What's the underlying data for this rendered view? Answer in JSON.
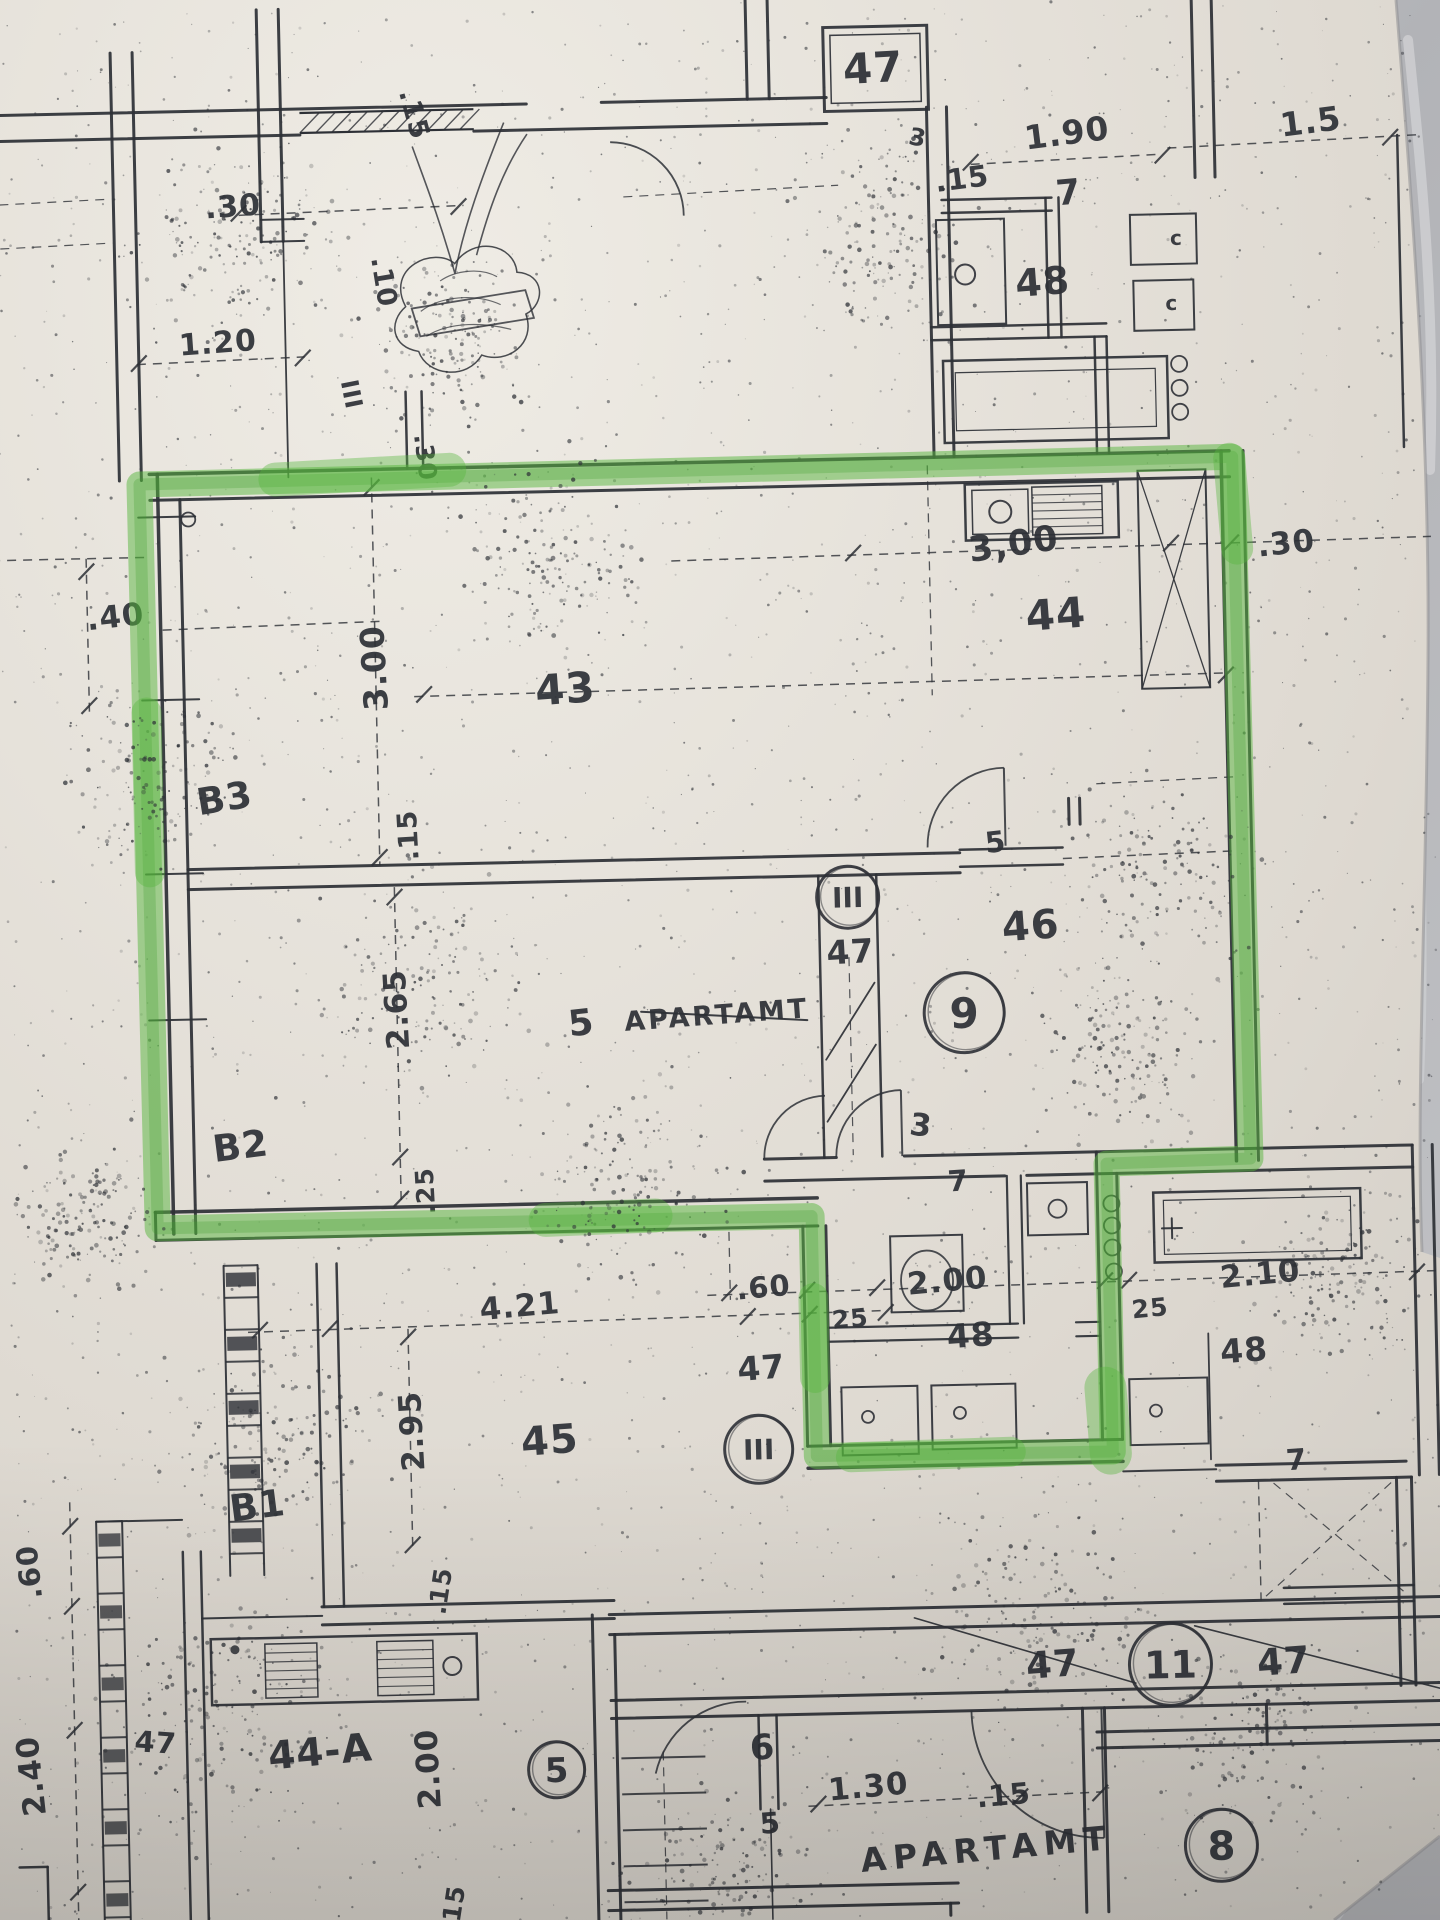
{
  "scene": {
    "description": "Photographed blueprint floor plan; apartment 9 outlined with green highlighter",
    "paper_color": "#e2ded6",
    "ink_color": "#2d3036",
    "highlight_color": "#58b63e",
    "marble_color": "#bdbec1"
  },
  "labels": {
    "texts": [
      {
        "t": "47",
        "x": 893,
        "y": 86,
        "s": 42,
        "r": -2,
        "name": "room-label-47-top"
      },
      {
        "t": "1.90",
        "x": 1086,
        "y": 152,
        "s": 33,
        "r": -6,
        "name": "dim-1-90"
      },
      {
        "t": "1.5",
        "x": 1330,
        "y": 146,
        "s": 33,
        "r": -6,
        "name": "dim-1-5"
      },
      {
        "t": ".15",
        "x": 980,
        "y": 194,
        "s": 29,
        "r": -6,
        "name": "dim-15-topright"
      },
      {
        "t": "7",
        "x": 1086,
        "y": 212,
        "s": 35,
        "r": -4,
        "name": "dim-7-topright"
      },
      {
        "t": "48",
        "x": 1058,
        "y": 302,
        "s": 38,
        "r": -3,
        "name": "room-label-48-top"
      },
      {
        "t": "3",
        "x": 934,
        "y": 150,
        "s": 24,
        "r": 12,
        "name": "door-label-3-top"
      },
      {
        "t": "c",
        "x": 1192,
        "y": 255,
        "s": 20,
        "r": 0,
        "name": "fixture-mark-c1"
      },
      {
        "t": "c",
        "x": 1186,
        "y": 320,
        "s": 20,
        "r": 0,
        "name": "fixture-mark-c2"
      },
      {
        "t": ".30",
        "x": 250,
        "y": 206,
        "s": 30,
        "r": -3,
        "name": "dim-30-topleft"
      },
      {
        "t": "1.20",
        "x": 232,
        "y": 342,
        "s": 30,
        "r": -3,
        "name": "dim-1-20"
      },
      {
        "t": ".15",
        "x": 424,
        "y": 110,
        "s": 27,
        "r": 76,
        "name": "dim-15-vert-topleft"
      },
      {
        "t": ".10",
        "x": 390,
        "y": 276,
        "s": 27,
        "r": 82,
        "name": "dim-10-vert"
      },
      {
        "t": "III",
        "x": 356,
        "y": 388,
        "s": 24,
        "r": 80,
        "name": "stair-mark-III-left"
      },
      {
        "t": ".40",
        "x": 124,
        "y": 614,
        "s": 31,
        "r": -5,
        "name": "dim-40-left"
      },
      {
        "t": "3.00",
        "x": 392,
        "y": 660,
        "s": 33,
        "r": -92,
        "name": "dim-3-00-vert"
      },
      {
        "t": ".30",
        "x": 428,
        "y": 452,
        "s": 25,
        "r": 84,
        "name": "dim-30-vert-small"
      },
      {
        "t": "43",
        "x": 572,
        "y": 700,
        "s": 42,
        "r": -3,
        "name": "room-label-43"
      },
      {
        "t": "3,00",
        "x": 1024,
        "y": 562,
        "s": 35,
        "r": -7,
        "name": "dim-3-00-kitchen"
      },
      {
        "t": ".30",
        "x": 1296,
        "y": 566,
        "s": 31,
        "r": -5,
        "name": "dim-30-right"
      },
      {
        "t": "44",
        "x": 1064,
        "y": 636,
        "s": 42,
        "r": -3,
        "name": "room-label-44"
      },
      {
        "t": "B3",
        "x": 230,
        "y": 800,
        "s": 37,
        "r": -8,
        "name": "bay-label-b3"
      },
      {
        "t": ".15",
        "x": 420,
        "y": 828,
        "s": 27,
        "r": -92,
        "name": "dim-15-midwall"
      },
      {
        "t": "5",
        "x": 999,
        "y": 858,
        "s": 29,
        "r": -5,
        "name": "dim-5-wall"
      },
      {
        "t": "46",
        "x": 1032,
        "y": 946,
        "s": 40,
        "r": -3,
        "name": "room-label-46"
      },
      {
        "t": "47",
        "x": 851,
        "y": 966,
        "s": 33,
        "r": -2,
        "name": "room-label-47-stair-upper"
      },
      {
        "t": "2.65",
        "x": 406,
        "y": 1002,
        "s": 31,
        "r": -92,
        "name": "dim-2-65-vert"
      },
      {
        "t": "5",
        "x": 581,
        "y": 1032,
        "s": 36,
        "r": -5,
        "name": "apartment-5-number"
      },
      {
        "t": "APARTAMT",
        "x": 716,
        "y": 1024,
        "s": 27,
        "r": -3,
        "ls": 3,
        "name": "apartment-5-script"
      },
      {
        "t": "B2",
        "x": 238,
        "y": 1148,
        "s": 37,
        "r": -6,
        "name": "bay-label-b2"
      },
      {
        "t": ".25",
        "x": 429,
        "y": 1184,
        "s": 25,
        "r": -92,
        "name": "dim-25-vert"
      },
      {
        "t": "3",
        "x": 916,
        "y": 1140,
        "s": 31,
        "r": 8,
        "name": "door-label-3-mid"
      },
      {
        "t": "7",
        "x": 954,
        "y": 1196,
        "s": 29,
        "r": -3,
        "name": "dim-7-mid"
      },
      {
        "t": ".60",
        "x": 757,
        "y": 1298,
        "s": 29,
        "r": -4,
        "name": "dim-60-bottom"
      },
      {
        "t": "2.00",
        "x": 941,
        "y": 1296,
        "s": 31,
        "r": -4,
        "name": "dim-2-00-bottom"
      },
      {
        "t": "2.10",
        "x": 1254,
        "y": 1296,
        "s": 31,
        "r": -4,
        "name": "dim-2-10"
      },
      {
        "t": "25",
        "x": 843,
        "y": 1330,
        "s": 25,
        "r": -4,
        "name": "dim-25-left"
      },
      {
        "t": "25",
        "x": 1143,
        "y": 1326,
        "s": 25,
        "r": -4,
        "name": "dim-25-right"
      },
      {
        "t": "48",
        "x": 963,
        "y": 1352,
        "s": 33,
        "r": -3,
        "name": "room-label-48-left"
      },
      {
        "t": "48",
        "x": 1236,
        "y": 1373,
        "s": 33,
        "r": -3,
        "name": "room-label-48-right"
      },
      {
        "t": "47",
        "x": 753,
        "y": 1380,
        "s": 33,
        "r": -3,
        "name": "room-label-47-stair-lower"
      },
      {
        "t": "4.21",
        "x": 513,
        "y": 1312,
        "s": 31,
        "r": -4,
        "name": "dim-4-21"
      },
      {
        "t": "2.95",
        "x": 412,
        "y": 1424,
        "s": 31,
        "r": -92,
        "name": "dim-2-95-vert"
      },
      {
        "t": "45",
        "x": 540,
        "y": 1450,
        "s": 40,
        "r": -3,
        "name": "room-label-45"
      },
      {
        "t": "B1",
        "x": 247,
        "y": 1508,
        "s": 37,
        "r": -6,
        "name": "bay-label-b1"
      },
      {
        "t": ".60",
        "x": 26,
        "y": 1556,
        "s": 29,
        "r": -95,
        "name": "dim-60-vert-left"
      },
      {
        "t": "2.40",
        "x": 24,
        "y": 1760,
        "s": 31,
        "r": -95,
        "name": "dim-2-40-vert"
      },
      {
        "t": ".15",
        "x": 435,
        "y": 1586,
        "s": 25,
        "r": -80,
        "name": "dim-15-kitchen5"
      },
      {
        "t": "47",
        "x": 138,
        "y": 1740,
        "s": 29,
        "r": 5,
        "name": "room-label-47-lowerleft"
      },
      {
        "t": "44-A",
        "x": 304,
        "y": 1756,
        "s": 39,
        "r": -4,
        "name": "room-label-44a"
      },
      {
        "t": "2.00",
        "x": 421,
        "y": 1762,
        "s": 31,
        "r": -92,
        "name": "dim-2-00-vert-44a"
      },
      {
        "t": ".15",
        "x": 441,
        "y": 1904,
        "s": 25,
        "r": -80,
        "name": "dim-15-bottomleft"
      },
      {
        "t": "6",
        "x": 746,
        "y": 1760,
        "s": 35,
        "r": -3,
        "name": "door-label-6"
      },
      {
        "t": "5",
        "x": 752,
        "y": 1834,
        "s": 29,
        "r": -3,
        "name": "door-label-5"
      },
      {
        "t": "1.30",
        "x": 851,
        "y": 1800,
        "s": 31,
        "r": -4,
        "name": "dim-1-30"
      },
      {
        "t": ".15",
        "x": 986,
        "y": 1811,
        "s": 29,
        "r": -4,
        "name": "dim-15-bottomright"
      },
      {
        "t": "47",
        "x": 1038,
        "y": 1684,
        "s": 37,
        "r": -3,
        "name": "room-label-47-corridor-left"
      },
      {
        "t": "47",
        "x": 1269,
        "y": 1686,
        "s": 37,
        "r": -3,
        "name": "room-label-47-corridor-right"
      },
      {
        "t": "7",
        "x": 1286,
        "y": 1482,
        "s": 29,
        "r": -3,
        "name": "dim-7-right"
      },
      {
        "t": "APARTAMT",
        "x": 968,
        "y": 1866,
        "s": 33,
        "r": -4,
        "ls": 7,
        "name": "apartment-8-script"
      }
    ],
    "circled": [
      {
        "t": "III",
        "x": 849,
        "y": 900,
        "cr": 31,
        "s": 28,
        "name": "stair-badge-III-upper"
      },
      {
        "t": "9",
        "x": 963,
        "y": 1018,
        "cr": 40,
        "s": 42,
        "name": "apartment-number-9"
      },
      {
        "t": "III",
        "x": 748,
        "y": 1450,
        "cr": 34,
        "s": 28,
        "name": "stair-badge-III-lower"
      },
      {
        "t": "5",
        "x": 539,
        "y": 1766,
        "cr": 28,
        "s": 34,
        "name": "apartment-number-5"
      },
      {
        "t": "11",
        "x": 1155,
        "y": 1674,
        "cr": 41,
        "s": 38,
        "name": "badge-11"
      },
      {
        "t": "8",
        "x": 1202,
        "y": 1856,
        "cr": 36,
        "s": 40,
        "name": "apartment-number-8"
      }
    ]
  }
}
